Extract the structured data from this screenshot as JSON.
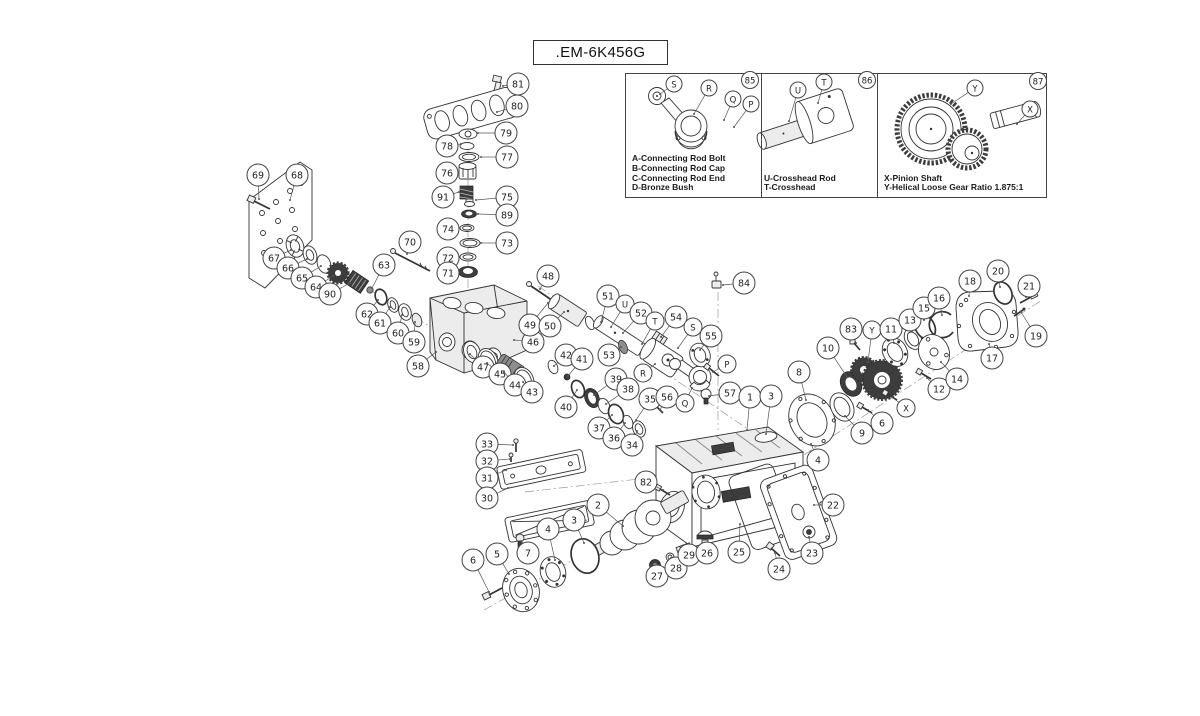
{
  "title": {
    "part_number": ".EM-6K456G"
  },
  "insets": {
    "panels": [
      {
        "badge": "85",
        "legend": [
          "A-Connecting Rod Bolt",
          "B-Connecting Rod Cap",
          "C-Connecting Rod End",
          "D-Bronze Bush"
        ]
      },
      {
        "badge": "86",
        "legend": [
          "U-Crosshead Rod",
          "T-Crosshead"
        ]
      },
      {
        "badge": "87",
        "legend": [
          "X-Pinion Shaft",
          "Y-Helical Loose Gear Ratio 1.875:1"
        ]
      }
    ]
  },
  "colors": {
    "line": "#333333",
    "callout_stroke": "#444444",
    "dark_fill": "#3d3d3d",
    "paper": "#ffffff"
  },
  "callouts": [
    {
      "l": "81",
      "x": 518,
      "y": 84,
      "tx": 503,
      "ty": 86
    },
    {
      "l": "80",
      "x": 517,
      "y": 106,
      "tx": 497,
      "ty": 112
    },
    {
      "l": "79",
      "x": 506,
      "y": 133,
      "tx": 478,
      "ty": 133
    },
    {
      "l": "78",
      "x": 447,
      "y": 146,
      "tx": 461,
      "ty": 144
    },
    {
      "l": "77",
      "x": 507,
      "y": 157,
      "tx": 481,
      "ty": 157
    },
    {
      "l": "76",
      "x": 447,
      "y": 173,
      "tx": 457,
      "ty": 172
    },
    {
      "l": "91",
      "x": 443,
      "y": 197,
      "tx": 459,
      "ty": 192
    },
    {
      "l": "75",
      "x": 507,
      "y": 197,
      "tx": 476,
      "ty": 200
    },
    {
      "l": "89",
      "x": 507,
      "y": 215,
      "tx": 478,
      "ty": 214
    },
    {
      "l": "74",
      "x": 448,
      "y": 229,
      "tx": 459,
      "ty": 228
    },
    {
      "l": "73",
      "x": 507,
      "y": 243,
      "tx": 481,
      "ty": 243
    },
    {
      "l": "72",
      "x": 448,
      "y": 258,
      "tx": 459,
      "ty": 257
    },
    {
      "l": "71",
      "x": 448,
      "y": 273,
      "tx": 458,
      "ty": 272
    },
    {
      "l": "69",
      "x": 258,
      "y": 175,
      "tx": 259,
      "ty": 199
    },
    {
      "l": "68",
      "x": 297,
      "y": 175,
      "tx": 290,
      "ty": 200
    },
    {
      "l": "67",
      "x": 274,
      "y": 258,
      "tx": 291,
      "ty": 250
    },
    {
      "l": "66",
      "x": 288,
      "y": 268,
      "tx": 307,
      "ty": 259
    },
    {
      "l": "65",
      "x": 302,
      "y": 278,
      "tx": 321,
      "ty": 266
    },
    {
      "l": "64",
      "x": 316,
      "y": 287,
      "tx": 333,
      "ty": 276
    },
    {
      "l": "90",
      "x": 330,
      "y": 294,
      "tx": 350,
      "ty": 283
    },
    {
      "l": "70",
      "x": 410,
      "y": 242,
      "tx": 407,
      "ty": 254
    },
    {
      "l": "63",
      "x": 384,
      "y": 265,
      "tx": 372,
      "ty": 288
    },
    {
      "l": "62",
      "x": 367,
      "y": 314,
      "tx": 378,
      "ty": 300
    },
    {
      "l": "61",
      "x": 380,
      "y": 323,
      "tx": 390,
      "ty": 307
    },
    {
      "l": "60",
      "x": 398,
      "y": 333,
      "tx": 402,
      "ty": 315
    },
    {
      "l": "59",
      "x": 414,
      "y": 342,
      "tx": 415,
      "ty": 322
    },
    {
      "l": "58",
      "x": 418,
      "y": 366,
      "tx": 436,
      "ty": 352
    },
    {
      "l": "47",
      "x": 483,
      "y": 367,
      "tx": 470,
      "ty": 354
    },
    {
      "l": "46",
      "x": 533,
      "y": 342,
      "tx": 514,
      "ty": 340
    },
    {
      "l": "45",
      "x": 500,
      "y": 374,
      "tx": 487,
      "ty": 363
    },
    {
      "l": "44",
      "x": 515,
      "y": 385,
      "tx": 504,
      "ty": 372
    },
    {
      "l": "43",
      "x": 532,
      "y": 392,
      "tx": 523,
      "ty": 382
    },
    {
      "l": "42",
      "x": 566,
      "y": 355,
      "tx": 554,
      "ty": 366
    },
    {
      "l": "41",
      "x": 582,
      "y": 359,
      "tx": 568,
      "ty": 376
    },
    {
      "l": "40",
      "x": 566,
      "y": 407,
      "tx": 577,
      "ty": 390
    },
    {
      "l": "39",
      "x": 616,
      "y": 379,
      "tx": 594,
      "ty": 395
    },
    {
      "l": "38",
      "x": 628,
      "y": 389,
      "tx": 606,
      "ty": 404
    },
    {
      "l": "37",
      "x": 599,
      "y": 428,
      "tx": 612,
      "ty": 415
    },
    {
      "l": "36",
      "x": 614,
      "y": 438,
      "tx": 625,
      "ty": 423
    },
    {
      "l": "34",
      "x": 632,
      "y": 445,
      "tx": 637,
      "ty": 431
    },
    {
      "l": "35",
      "x": 650,
      "y": 399,
      "tx": 636,
      "ty": 420
    },
    {
      "l": "56",
      "x": 667,
      "y": 397,
      "tx": 660,
      "ty": 410
    },
    {
      "l": "48",
      "x": 548,
      "y": 276,
      "tx": 540,
      "ty": 289
    },
    {
      "l": "49",
      "x": 530,
      "y": 325,
      "tx": 548,
      "ty": 303
    },
    {
      "l": "50",
      "x": 550,
      "y": 326,
      "tx": 564,
      "ty": 312
    },
    {
      "l": "51",
      "x": 608,
      "y": 296,
      "tx": 601,
      "ty": 322
    },
    {
      "l": "U",
      "x": 625,
      "y": 304,
      "tx": 611,
      "ty": 327,
      "r": 9
    },
    {
      "l": "52",
      "x": 641,
      "y": 313,
      "tx": 623,
      "ty": 333
    },
    {
      "l": "T",
      "x": 655,
      "y": 321,
      "tx": 642,
      "ty": 344,
      "r": 9
    },
    {
      "l": "54",
      "x": 676,
      "y": 317,
      "tx": 661,
      "ty": 337
    },
    {
      "l": "S",
      "x": 693,
      "y": 327,
      "tx": 678,
      "ty": 348,
      "r": 9
    },
    {
      "l": "55",
      "x": 711,
      "y": 336,
      "tx": 700,
      "ty": 350
    },
    {
      "l": "53",
      "x": 609,
      "y": 355,
      "tx": 621,
      "ty": 347
    },
    {
      "l": "R",
      "x": 643,
      "y": 373,
      "tx": 655,
      "ty": 364,
      "r": 9
    },
    {
      "l": "P",
      "x": 727,
      "y": 364,
      "tx": 713,
      "ty": 372,
      "r": 9
    },
    {
      "l": "Q",
      "x": 685,
      "y": 403,
      "tx": 692,
      "ty": 388,
      "r": 9
    },
    {
      "l": "57",
      "x": 730,
      "y": 393,
      "tx": 709,
      "ty": 396
    },
    {
      "l": "84",
      "x": 744,
      "y": 283,
      "tx": 723,
      "ty": 285
    },
    {
      "l": "1",
      "x": 750,
      "y": 397,
      "tx": 747,
      "ty": 430
    },
    {
      "l": "3",
      "x": 771,
      "y": 396,
      "tx": 766,
      "ty": 434
    },
    {
      "l": "8",
      "x": 799,
      "y": 372,
      "tx": 806,
      "ty": 400
    },
    {
      "l": "4",
      "x": 818,
      "y": 460,
      "tx": 811,
      "ty": 444
    },
    {
      "l": "9",
      "x": 862,
      "y": 433,
      "tx": 845,
      "ty": 416
    },
    {
      "l": "6",
      "x": 882,
      "y": 423,
      "tx": 868,
      "ty": 410
    },
    {
      "l": "10",
      "x": 828,
      "y": 348,
      "tx": 847,
      "ty": 377
    },
    {
      "l": "83",
      "x": 851,
      "y": 329,
      "tx": 856,
      "ty": 343
    },
    {
      "l": "Y",
      "x": 872,
      "y": 330,
      "tx": 868,
      "ty": 362,
      "r": 9
    },
    {
      "l": "11",
      "x": 891,
      "y": 329,
      "tx": 894,
      "ty": 343
    },
    {
      "l": "X",
      "x": 906,
      "y": 408,
      "tx": 892,
      "ty": 397,
      "r": 9
    },
    {
      "l": "12",
      "x": 939,
      "y": 389,
      "tx": 927,
      "ty": 378
    },
    {
      "l": "13",
      "x": 910,
      "y": 320,
      "tx": 912,
      "ty": 331
    },
    {
      "l": "14",
      "x": 957,
      "y": 379,
      "tx": 941,
      "ty": 362
    },
    {
      "l": "15",
      "x": 924,
      "y": 308,
      "tx": 924,
      "ty": 320
    },
    {
      "l": "16",
      "x": 939,
      "y": 298,
      "tx": 942,
      "ty": 315
    },
    {
      "l": "18",
      "x": 970,
      "y": 281,
      "tx": 969,
      "ty": 296
    },
    {
      "l": "20",
      "x": 998,
      "y": 271,
      "tx": 1000,
      "ty": 287
    },
    {
      "l": "21",
      "x": 1029,
      "y": 286,
      "tx": 1026,
      "ty": 297
    },
    {
      "l": "19",
      "x": 1036,
      "y": 336,
      "tx": 1021,
      "ty": 312
    },
    {
      "l": "17",
      "x": 992,
      "y": 358,
      "tx": 989,
      "ty": 344
    },
    {
      "l": "33",
      "x": 487,
      "y": 444,
      "tx": 513,
      "ty": 445
    },
    {
      "l": "32",
      "x": 487,
      "y": 461,
      "tx": 510,
      "ty": 459
    },
    {
      "l": "31",
      "x": 487,
      "y": 478,
      "tx": 506,
      "ty": 470
    },
    {
      "l": "30",
      "x": 487,
      "y": 498,
      "tx": 508,
      "ty": 488
    },
    {
      "l": "82",
      "x": 646,
      "y": 482,
      "tx": 663,
      "ty": 490
    },
    {
      "l": "2",
      "x": 598,
      "y": 505,
      "tx": 623,
      "ty": 526
    },
    {
      "l": "3",
      "x": 574,
      "y": 520,
      "tx": 584,
      "ty": 543
    },
    {
      "l": "4",
      "x": 548,
      "y": 529,
      "tx": 555,
      "ty": 560
    },
    {
      "l": "7",
      "x": 528,
      "y": 553,
      "tx": 521,
      "ty": 541
    },
    {
      "l": "5",
      "x": 497,
      "y": 554,
      "tx": 509,
      "ty": 574
    },
    {
      "l": "6",
      "x": 473,
      "y": 560,
      "tx": 489,
      "ty": 592
    },
    {
      "l": "27",
      "x": 657,
      "y": 576,
      "tx": 655,
      "ty": 567
    },
    {
      "l": "28",
      "x": 676,
      "y": 568,
      "tx": 671,
      "ty": 558
    },
    {
      "l": "29",
      "x": 689,
      "y": 555,
      "tx": 685,
      "ty": 549
    },
    {
      "l": "26",
      "x": 707,
      "y": 553,
      "tx": 705,
      "ty": 543
    },
    {
      "l": "25",
      "x": 739,
      "y": 552,
      "tx": 740,
      "ty": 524
    },
    {
      "l": "24",
      "x": 779,
      "y": 569,
      "tx": 775,
      "ty": 553
    },
    {
      "l": "23",
      "x": 812,
      "y": 553,
      "tx": 809,
      "ty": 537
    },
    {
      "l": "22",
      "x": 833,
      "y": 505,
      "tx": 814,
      "ty": 505
    },
    {
      "l": "85",
      "x": 750,
      "y": 80,
      "r": 8.5,
      "noline": true
    },
    {
      "l": "S",
      "x": 674,
      "y": 84,
      "tx": 660,
      "ty": 94,
      "r": 8
    },
    {
      "l": "R",
      "x": 709,
      "y": 88,
      "tx": 694,
      "ty": 114,
      "r": 8
    },
    {
      "l": "Q",
      "x": 733,
      "y": 99,
      "tx": 724,
      "ty": 120,
      "r": 8
    },
    {
      "l": "P",
      "x": 751,
      "y": 104,
      "tx": 734,
      "ty": 127,
      "r": 8
    },
    {
      "l": "86",
      "x": 867,
      "y": 80,
      "r": 8.5,
      "noline": true
    },
    {
      "l": "U",
      "x": 798,
      "y": 90,
      "tx": 789,
      "ty": 121,
      "r": 8
    },
    {
      "l": "T",
      "x": 824,
      "y": 82,
      "tx": 818,
      "ty": 103,
      "r": 8
    },
    {
      "l": "87",
      "x": 1038,
      "y": 81,
      "r": 8.5,
      "noline": true
    },
    {
      "l": "Y",
      "x": 975,
      "y": 88,
      "tx": 951,
      "ty": 104,
      "r": 8
    },
    {
      "l": "X",
      "x": 1030,
      "y": 109,
      "tx": 1017,
      "ty": 124,
      "r": 8
    }
  ]
}
